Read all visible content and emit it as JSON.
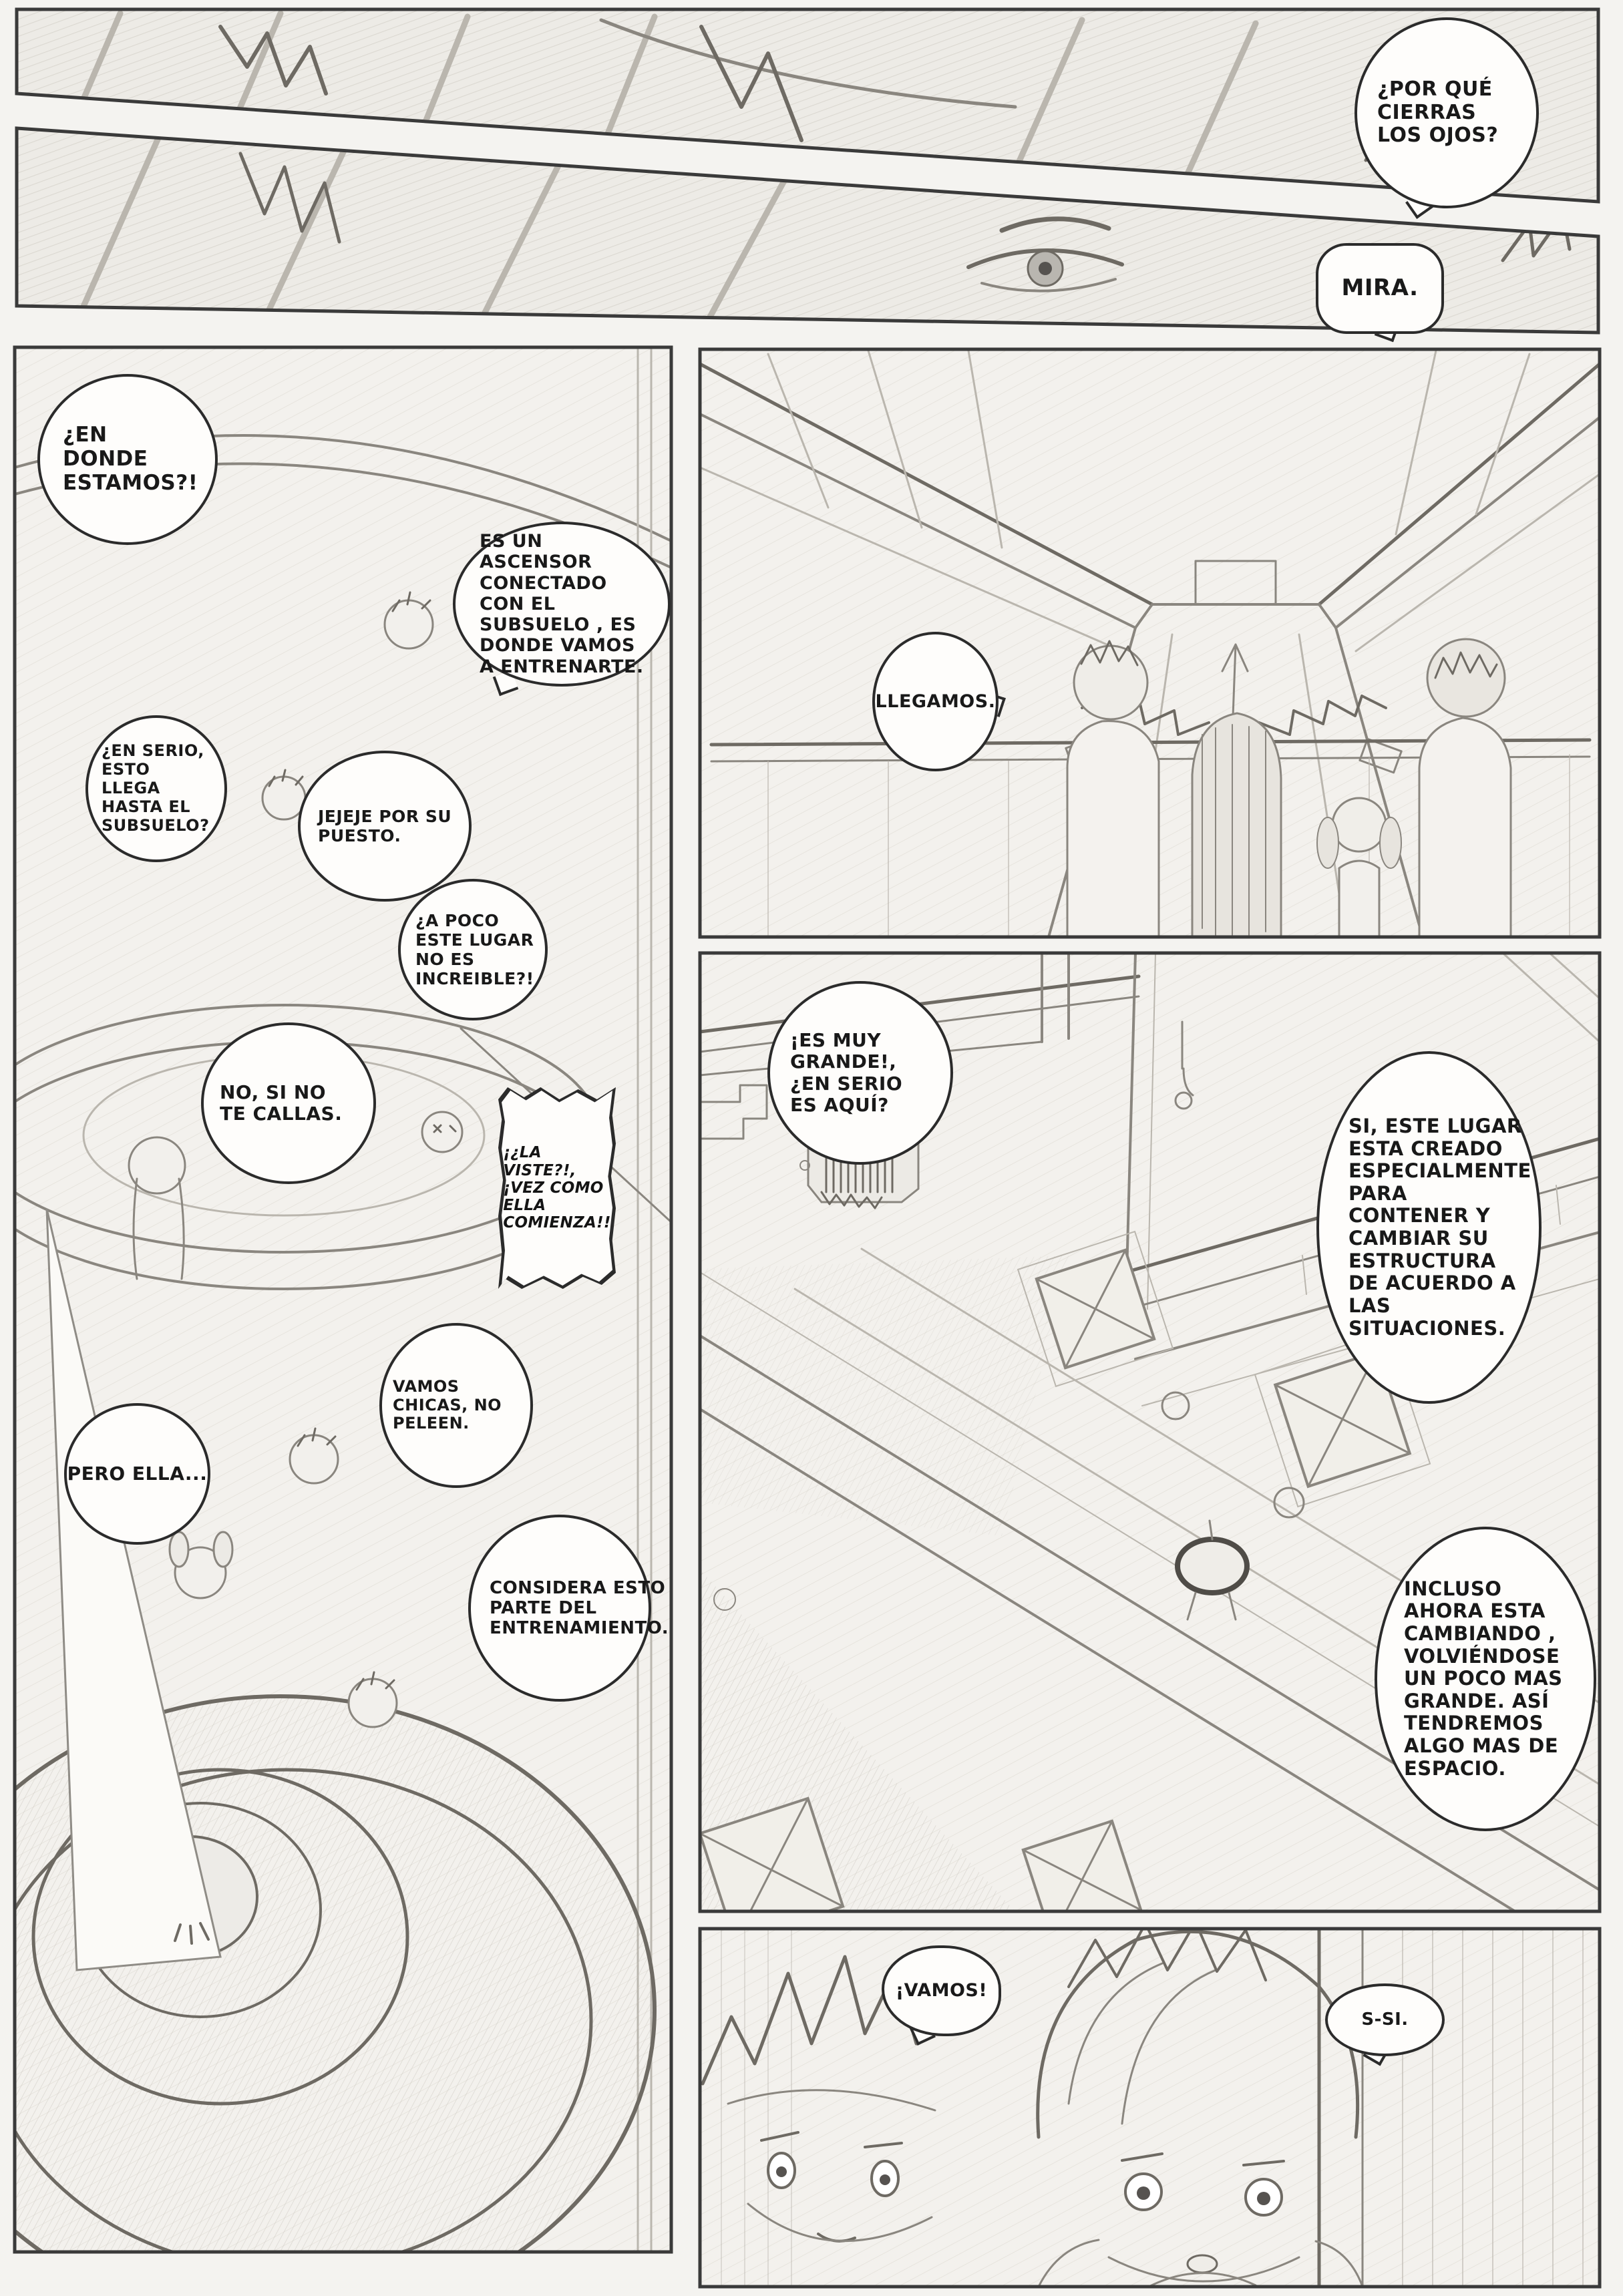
{
  "page": {
    "type": "hand-drawn manga page (pencil sketch scan)",
    "language": "es"
  },
  "colors": {
    "paper": "#f4f3f0",
    "ink": "#191919",
    "panel_border": "#3a3a3a",
    "pencil": "#8a867f",
    "bubble_fill": "#fefdfb"
  },
  "bubbles": [
    {
      "id": "por-que",
      "text": "¿POR QUÉ CIERRAS LOS OJOS?"
    },
    {
      "id": "mira",
      "text": "MIRA."
    },
    {
      "id": "en-donde",
      "text": "¿EN DONDE ESTAMOS?!"
    },
    {
      "id": "ascensor",
      "text": "ES UN ASCENSOR CONECTADO CON EL SUBSUELO , ES DONDE VAMOS A ENTRENARTE."
    },
    {
      "id": "en-serio",
      "text": "¿EN SERIO, ESTO LLEGA HASTA EL SUBSUELO?"
    },
    {
      "id": "jejeje",
      "text": "JEJEJE POR SU PUESTO."
    },
    {
      "id": "a-poco",
      "text": "¿A POCO ESTE LUGAR NO ES INCREIBLE?!"
    },
    {
      "id": "no-si",
      "text": "NO, SI NO TE CALLAS."
    },
    {
      "id": "la-viste",
      "text": "¡¿LA VISTE?!, ¡VEZ COMO ELLA COMIENZA!!"
    },
    {
      "id": "vamos-chicas",
      "text": "VAMOS CHICAS, NO PELEEN."
    },
    {
      "id": "pero-ella",
      "text": "PERO ELLA..."
    },
    {
      "id": "considera",
      "text": "CONSIDERA ESTO PARTE DEL ENTRENAMIENTO."
    },
    {
      "id": "llegamos",
      "text": "LLEGAMOS."
    },
    {
      "id": "es-muy-grande",
      "text": "¡ES MUY GRANDE!, ¿EN SERIO ES AQUÍ?"
    },
    {
      "id": "si-este",
      "text": "SI, ESTE LUGAR ESTA CREADO ESPECIALMENTE PARA CONTENER Y CAMBIAR SU ESTRUCTURA DE ACUERDO A LAS SITUACIONES."
    },
    {
      "id": "incluso",
      "text": "INCLUSO AHORA ESTA CAMBIANDO , VOLVIÉNDOSE UN POCO MAS GRANDE. ASÍ TENDREMOS ALGO MAS DE ESPACIO."
    },
    {
      "id": "vamos",
      "text": "¡VAMOS!"
    },
    {
      "id": "s-si",
      "text": "S-SI."
    }
  ]
}
